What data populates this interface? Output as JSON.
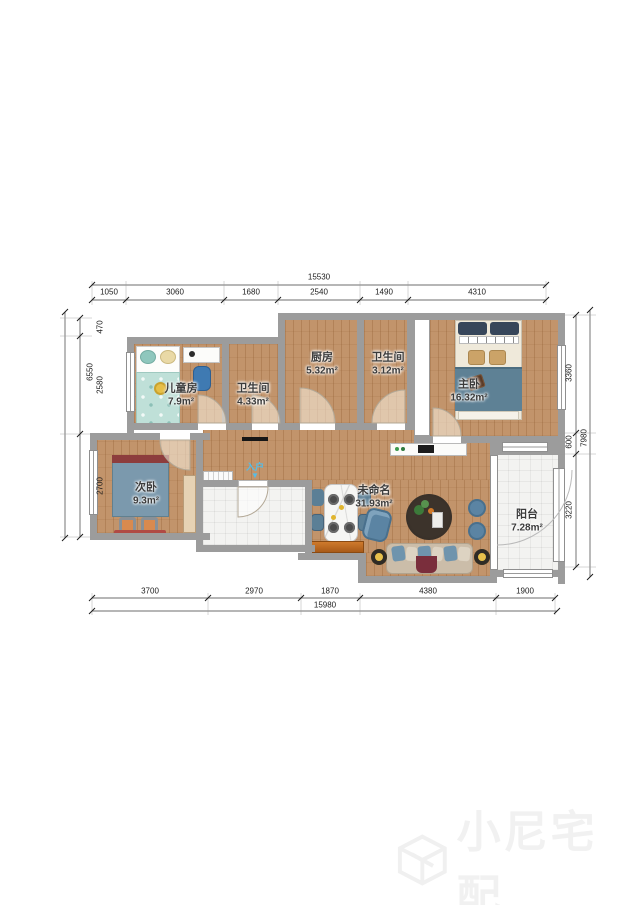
{
  "rooms": [
    {
      "name": "儿童房",
      "area": "7.9m²"
    },
    {
      "name": "卫生间",
      "area": "4.33m²"
    },
    {
      "name": "厨房",
      "area": "5.32m²"
    },
    {
      "name": "卫生间",
      "area": "3.12m²"
    },
    {
      "name": "主卧",
      "area": "16.32m²"
    },
    {
      "name": "次卧",
      "area": "9.3m²"
    },
    {
      "name": "未命名",
      "area": "31.93m²"
    },
    {
      "name": "阳台",
      "area": "7.28m²"
    }
  ],
  "entry": {
    "label": "入户",
    "arrow": "▼"
  },
  "dims": {
    "top": {
      "total": "15530",
      "segments": [
        "1050",
        "3060",
        "1680",
        "2540",
        "1490",
        "4310"
      ]
    },
    "bottom": {
      "total": "15980",
      "segments": [
        "3700",
        "2970",
        "1870",
        "4380",
        "1900"
      ]
    },
    "left": {
      "total": "6550",
      "segments": [
        "470",
        "2580",
        "2700"
      ]
    },
    "right": {
      "total": "7980",
      "segments": [
        "3360",
        "600",
        "3220"
      ]
    }
  },
  "watermark": {
    "text": "小尼宅配"
  },
  "colors": {
    "wall": "#9c9c9c",
    "wood": "#c2946b",
    "tile": "#f3f3f1",
    "accent_blue": "#6f94ad",
    "entry_blue": "#54bde8"
  }
}
